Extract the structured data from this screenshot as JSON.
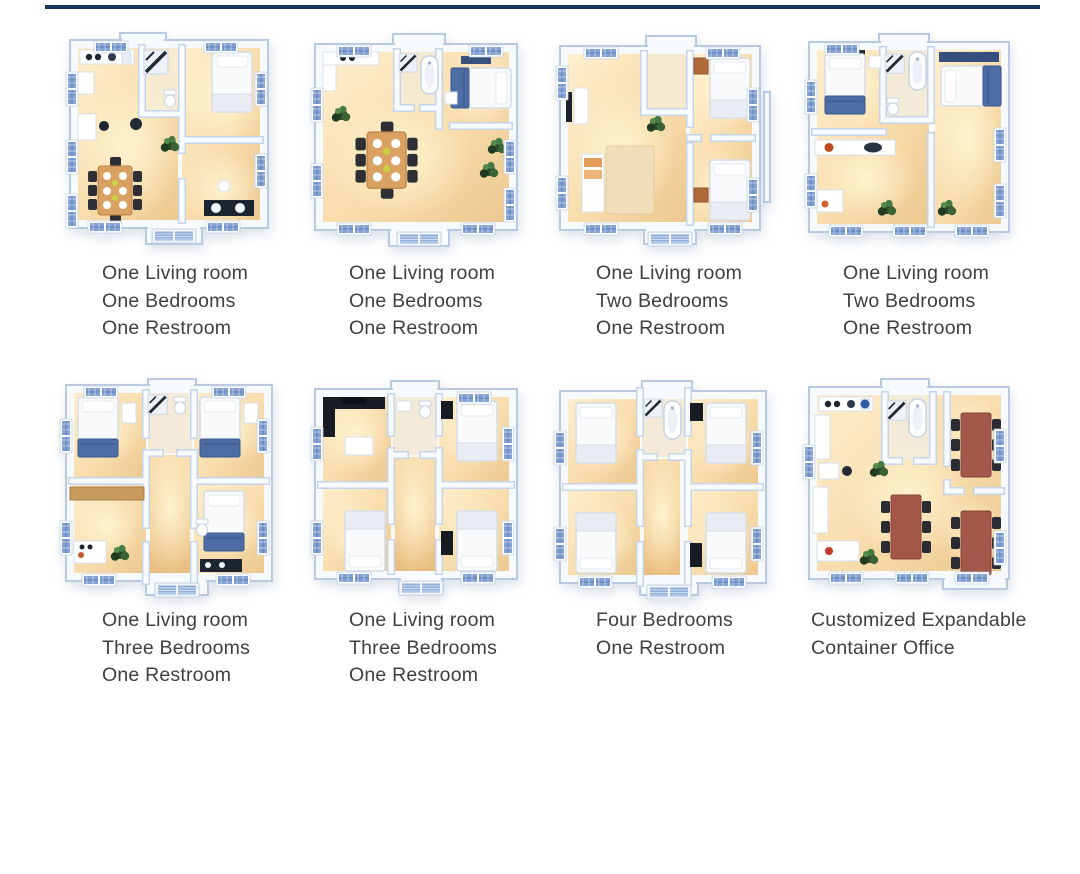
{
  "divider": {
    "color": "#17375e"
  },
  "palette": {
    "floor_warm": "#f2d3a0",
    "wall_blue": "#b9c9e2",
    "window_glass": "#84a1d3",
    "caption_text": "#3f3f3f",
    "office_table": "#a3574a"
  },
  "cards": [
    {
      "plan": "one-living-one-bed-one-rest-a",
      "lines": [
        "One Living room",
        "One Bedrooms",
        "One Restroom"
      ]
    },
    {
      "plan": "one-living-one-bed-one-rest-b",
      "lines": [
        "One Living room",
        "One Bedrooms",
        "One Restroom"
      ]
    },
    {
      "plan": "one-living-two-bed-one-rest-a",
      "lines": [
        "One Living room",
        "Two Bedrooms",
        "One Restroom"
      ]
    },
    {
      "plan": "one-living-two-bed-one-rest-b",
      "lines": [
        "One Living room",
        "Two Bedrooms",
        "One Restroom"
      ]
    },
    {
      "plan": "one-living-three-bed-one-rest-a",
      "lines": [
        "One Living room",
        "Three Bedrooms",
        "One Restroom"
      ]
    },
    {
      "plan": "one-living-three-bed-one-rest-b",
      "lines": [
        "One Living room",
        "Three Bedrooms",
        "One Restroom"
      ]
    },
    {
      "plan": "four-bed-one-rest",
      "lines": [
        "Four Bedrooms",
        "One Restroom"
      ]
    },
    {
      "plan": "customized-expandable-office",
      "lines": [
        "Customized Expandable",
        "Container Office"
      ]
    }
  ]
}
